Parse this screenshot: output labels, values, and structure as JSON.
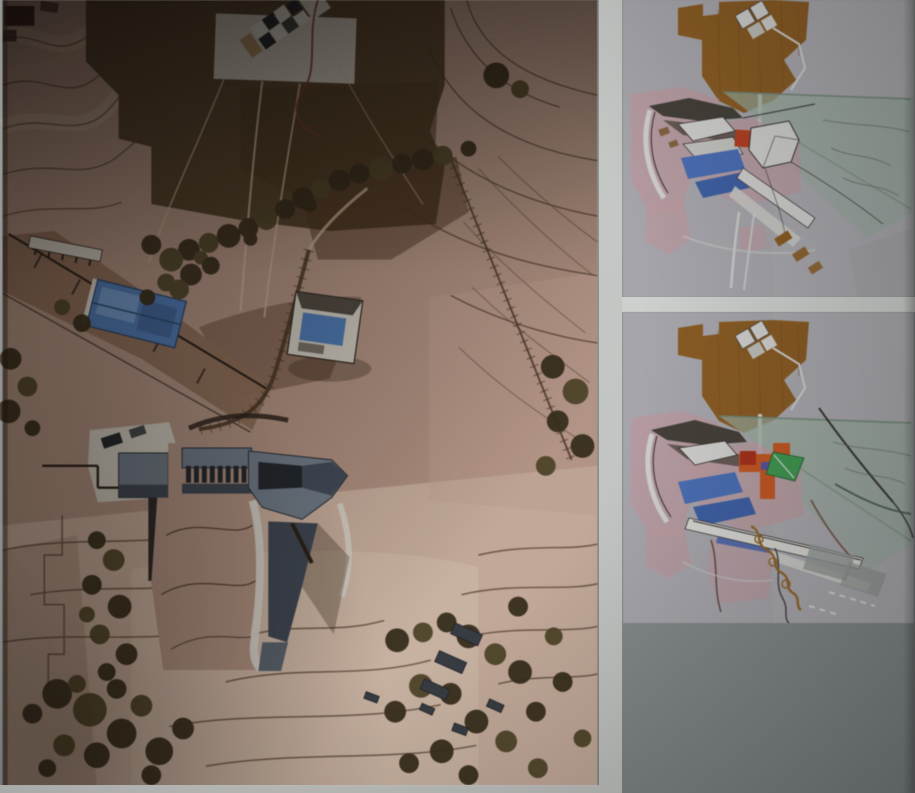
{
  "scene": {
    "type": "photograph",
    "subject": "architectural site model aerial photograph with two masterplan diagrams pinned on a gray board",
    "panel_names": [
      "site-model-photo",
      "masterplan-diagram-top",
      "masterplan-diagram-bottom"
    ],
    "text_content": []
  },
  "colors": {
    "board_top": "#9ba19f",
    "board_bottom": "#7c8384",
    "mat_strip": "#c6c9c6",
    "gap_strip": "#cdd0cd",
    "terrain": "#b29180",
    "terrain_light": "#c9ad9b",
    "terrain_lighter": "#d6bfab",
    "terrain_pink": "#c2a191",
    "terrain_dim": "#a78a77",
    "terrain_band": "#c2a68e",
    "plateau": "#55422c",
    "plateau_dark": "#49381f",
    "contour": "#4a3424",
    "contour_red": "#7a3a28",
    "ridge": "#8f6e55",
    "wall_dark": "#2c211a",
    "gully": "#4f3320",
    "tree": "#3a2f1c",
    "tree_alt": "#514628",
    "water": "#4b7ab8",
    "water_light": "#6e97cc",
    "water_deep": "#3f66a0",
    "white_model": "#cfcabe",
    "white_bright": "#d8d4ca",
    "bldg": "#3e4754",
    "bldg_light": "#707c8a",
    "bldg_dark": "#23282e",
    "path_light": "#c8b294",
    "maroon": "#3a2121",
    "block": "#383e46",
    "roof_tan": "#a98a5e",
    "panel_bg": "#b0afb6",
    "panel_bg2": "#b6b5bc",
    "panel_pink": "#c5a2a9",
    "panel_green": "#9eb4a5",
    "panel_ochre": "#925f20",
    "panel_white": "#dcdcda",
    "panel_outline": "#35302c",
    "panel_blue": "#4a72c2",
    "panel_blue_deep": "#3d63b0",
    "panel_red": "#c13f20",
    "panel_orange": "#d2591f",
    "panel_green_bright": "#3da052",
    "panel_purple": "#5a55aa",
    "panel_squiggle": "#9a6a28",
    "panel_gray_block": "#9aa09d",
    "panel_dark_wing": "#46403a",
    "panel_dark_wing2": "#5a5048",
    "panel_tan": "#8a6840"
  }
}
